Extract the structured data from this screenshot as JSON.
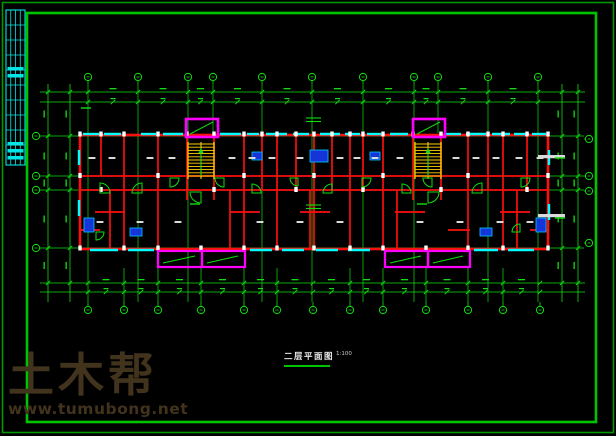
{
  "title": {
    "text": "二层平面图",
    "scale": "1:100"
  },
  "watermark": {
    "name": "土木帮",
    "url": "www.tumubong.net"
  },
  "colors": {
    "background": "#000000",
    "frame_outer": "#009900",
    "frame_inner": "#00c300",
    "titleblock": "#00e5e5",
    "grid": "#0fdf0f",
    "wall": "#fb0f0f",
    "window": "#00ffff",
    "balcony": "#ff00ff",
    "stair": "#ffd000",
    "column": "#ffffff",
    "fixture_fill": "#1535d8",
    "fixture_stroke": "#00ccff",
    "label": "#d9d9d9",
    "watermark": "#42331d"
  },
  "plan": {
    "frame": {
      "outer": [
        2.5,
        2.5,
        611,
        430
      ],
      "inner": [
        27,
        13,
        569,
        409
      ]
    },
    "titleblock": {
      "rect": [
        6,
        10,
        19,
        155
      ],
      "vxs": [
        10.75,
        15.5,
        20.25
      ],
      "hys": [
        25,
        40,
        55,
        70,
        85,
        100,
        115,
        130,
        145
      ],
      "blobs": [
        [
          7.5,
          67
        ],
        [
          7.5,
          74
        ],
        [
          7.5,
          142
        ],
        [
          7.5,
          149
        ],
        [
          7.5,
          156
        ]
      ]
    },
    "grid": {
      "top_x": [
        88,
        138,
        188,
        213,
        262,
        312,
        363,
        414,
        438,
        488,
        538
      ],
      "top_y": 77,
      "bottom_x": [
        88,
        124,
        158,
        201,
        244,
        277,
        313,
        350,
        383,
        426,
        468,
        503,
        540
      ],
      "bottom_y": 310,
      "left_y": [
        136,
        176,
        190,
        248
      ],
      "left_x": 36,
      "right_y": [
        139,
        176,
        191,
        243
      ],
      "right_x": 589,
      "full_v": [
        88,
        138,
        188,
        262,
        312,
        363,
        414,
        488,
        538
      ],
      "v_span": [
        84,
        302
      ],
      "stub_top": [
        213,
        438
      ],
      "stub_top_span": [
        84,
        133
      ],
      "stub_bottom": [
        124,
        158,
        201,
        244,
        277,
        350,
        383,
        426,
        468,
        503
      ],
      "stub_bottom_span": [
        268,
        303
      ],
      "h_lines": [
        136,
        176,
        190,
        248
      ],
      "h_span": [
        42,
        584
      ]
    },
    "dims": {
      "top_ys": [
        92,
        102
      ],
      "bottom_ys": [
        283,
        292
      ],
      "h_span": [
        40,
        585
      ],
      "left_xs": [
        48,
        70
      ],
      "right_xs": [
        562,
        578
      ],
      "v_span": [
        84,
        302
      ],
      "side_tick_ys": [
        92,
        136,
        176,
        190,
        248,
        283
      ]
    },
    "walls": {
      "ext": [
        80,
        135,
        468,
        114
      ],
      "int_v": [
        [
          101,
          135,
          176
        ],
        [
          124,
          135,
          249
        ],
        [
          158,
          135,
          249
        ],
        [
          187,
          133,
          200
        ],
        [
          214,
          133,
          200
        ],
        [
          244,
          135,
          249
        ],
        [
          262,
          135,
          190
        ],
        [
          277,
          135,
          249
        ],
        [
          296,
          135,
          190
        ],
        [
          314,
          135,
          249
        ],
        [
          332,
          135,
          190
        ],
        [
          350,
          135,
          249
        ],
        [
          363,
          135,
          190
        ],
        [
          383,
          135,
          249
        ],
        [
          413,
          133,
          200
        ],
        [
          441,
          133,
          200
        ],
        [
          468,
          135,
          249
        ],
        [
          488,
          135,
          190
        ],
        [
          503,
          135,
          249
        ],
        [
          527,
          135,
          190
        ],
        [
          110,
          190,
          249
        ],
        [
          230,
          190,
          249
        ],
        [
          310,
          190,
          249
        ],
        [
          397,
          190,
          249
        ],
        [
          517,
          190,
          249
        ]
      ],
      "int_h": [
        [
          176,
          80,
          548
        ],
        [
          190,
          80,
          548
        ],
        [
          212,
          95,
          125
        ],
        [
          212,
          230,
          260
        ],
        [
          212,
          300,
          330
        ],
        [
          212,
          395,
          425
        ],
        [
          212,
          500,
          530
        ],
        [
          230,
          80,
          100
        ],
        [
          230,
          448,
          470
        ],
        [
          230,
          530,
          548
        ]
      ]
    },
    "windows": {
      "top_y": 134,
      "top": [
        [
          83,
          99
        ],
        [
          104,
          121
        ],
        [
          141,
          156
        ],
        [
          163,
          183
        ],
        [
          220,
          241
        ],
        [
          247,
          259
        ],
        [
          266,
          287
        ],
        [
          293,
          309
        ],
        [
          320,
          340
        ],
        [
          345,
          360
        ],
        [
          367,
          381
        ],
        [
          390,
          408
        ],
        [
          446,
          461
        ],
        [
          466,
          486
        ],
        [
          492,
          510
        ],
        [
          514,
          529
        ],
        [
          532,
          546
        ]
      ],
      "bottom_y": 250,
      "bottom": [
        [
          90,
          118
        ],
        [
          128,
          154
        ],
        [
          250,
          272
        ],
        [
          282,
          304
        ],
        [
          316,
          338
        ],
        [
          348,
          370
        ],
        [
          474,
          498
        ],
        [
          508,
          534
        ]
      ],
      "left_x": 79,
      "left": [
        [
          150,
          165
        ],
        [
          200,
          216
        ]
      ],
      "right_x": 549,
      "right": [
        [
          150,
          165
        ],
        [
          204,
          220
        ]
      ]
    },
    "columns": [
      {
        "y": 131.5,
        "xs": [
          80,
          101,
          124,
          158,
          187,
          214,
          244,
          262,
          277,
          296,
          314,
          332,
          350,
          363,
          383,
          413,
          441,
          468,
          488,
          503,
          527,
          548
        ]
      },
      {
        "y": 245.5,
        "xs": [
          80,
          124,
          158,
          201,
          244,
          277,
          314,
          350,
          383,
          426,
          468,
          503,
          548
        ]
      },
      {
        "y": 173,
        "xs": [
          80,
          158,
          244,
          314,
          383,
          468,
          548
        ]
      },
      {
        "y": 187,
        "xs": [
          101,
          214,
          296,
          363,
          441,
          527
        ]
      }
    ],
    "stairs": [
      [
        188,
        142,
        26,
        37
      ],
      [
        415,
        142,
        26,
        37
      ]
    ],
    "shafts": [
      [
        186,
        119,
        32,
        18
      ],
      [
        413,
        119,
        32,
        18
      ]
    ],
    "balconies": [
      [
        158,
        251,
        44,
        16
      ],
      [
        202,
        251,
        43,
        16
      ],
      [
        385,
        251,
        43,
        16
      ],
      [
        428,
        251,
        42,
        16
      ]
    ],
    "doors": [
      [
        100,
        193,
        10,
        270
      ],
      [
        142,
        193,
        10,
        180
      ],
      [
        170,
        178,
        9,
        0
      ],
      [
        224,
        178,
        9,
        90
      ],
      [
        252,
        193,
        9,
        270
      ],
      [
        298,
        178,
        8,
        90
      ],
      [
        332,
        193,
        9,
        180
      ],
      [
        362,
        178,
        9,
        0
      ],
      [
        402,
        193,
        9,
        270
      ],
      [
        432,
        178,
        9,
        90
      ],
      [
        482,
        193,
        10,
        180
      ],
      [
        521,
        178,
        9,
        0
      ],
      [
        201,
        192,
        11,
        90
      ],
      [
        428,
        192,
        11,
        0
      ],
      [
        96,
        232,
        8,
        0
      ],
      [
        520,
        232,
        8,
        180
      ]
    ],
    "fixtures": [
      [
        310,
        150,
        18,
        12
      ],
      [
        252,
        152,
        10,
        8
      ],
      [
        370,
        152,
        10,
        8
      ],
      [
        84,
        218,
        10,
        14
      ],
      [
        536,
        218,
        10,
        14
      ],
      [
        130,
        228,
        12,
        8
      ],
      [
        480,
        228,
        12,
        8
      ]
    ],
    "labels": [
      [
        92,
        158
      ],
      [
        112,
        158
      ],
      [
        150,
        158
      ],
      [
        172,
        158
      ],
      [
        232,
        158
      ],
      [
        252,
        158
      ],
      [
        272,
        158
      ],
      [
        300,
        158
      ],
      [
        340,
        158
      ],
      [
        357,
        158
      ],
      [
        375,
        158
      ],
      [
        400,
        158
      ],
      [
        456,
        158
      ],
      [
        476,
        158
      ],
      [
        496,
        158
      ],
      [
        519,
        158
      ],
      [
        540,
        158
      ],
      [
        100,
        222
      ],
      [
        140,
        222
      ],
      [
        178,
        222
      ],
      [
        260,
        222
      ],
      [
        300,
        222
      ],
      [
        340,
        222
      ],
      [
        420,
        222
      ],
      [
        460,
        222
      ],
      [
        500,
        222
      ],
      [
        530,
        222
      ]
    ],
    "notes": [
      [
        538,
        155
      ],
      [
        538,
        214
      ]
    ],
    "joints": [
      [
        306,
        118,
        321,
        118
      ],
      [
        306,
        121.5,
        321,
        121.5
      ],
      [
        306,
        205,
        321,
        205
      ],
      [
        306,
        208.5,
        321,
        208.5
      ]
    ],
    "stair_arrows": [
      [
        201,
        148,
        201,
        176
      ],
      [
        428,
        148,
        428,
        176
      ]
    ],
    "green_dashes": [
      [
        195,
        204
      ],
      [
        422,
        204
      ],
      [
        86,
        108
      ],
      [
        560,
        158
      ],
      [
        560,
        218
      ]
    ]
  }
}
